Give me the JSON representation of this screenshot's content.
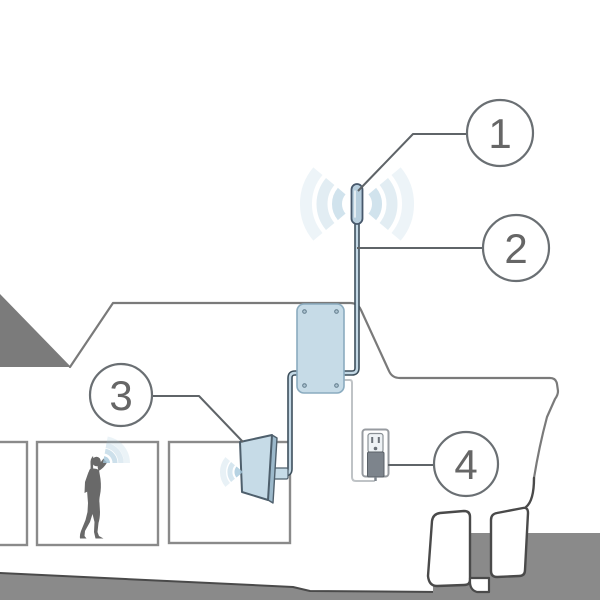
{
  "figure": {
    "type": "signal-booster-installation-diagram",
    "callouts": [
      {
        "number": "1"
      },
      {
        "number": "2"
      },
      {
        "number": "3"
      },
      {
        "number": "4"
      }
    ]
  },
  "colors": {
    "background": "#ffffff",
    "device_fill": "#c6dbe7",
    "device_stroke": "#8aabbf",
    "antenna_fill": "#b7cedd",
    "antenna_stroke": "#47586b",
    "cable_dark": "#3d4f5c",
    "cable_core": "#c3d8e5",
    "cord_gray": "#bfc3c6",
    "wave_blue": "#a4c7db",
    "outline_gray": "#7a7a7a",
    "dark_line": "#4a4a4a",
    "ground_gray": "#8a8a8a",
    "roof_gray": "#7b7b7b",
    "silhouette_gray": "#696969",
    "window_gray": "#8a8a8a",
    "callout_stroke": "#6a6f73",
    "callout_line": "#5f6468",
    "callout_text": "#666666",
    "plug_gray": "#7d848c",
    "outlet_detail": "#6b7178"
  }
}
